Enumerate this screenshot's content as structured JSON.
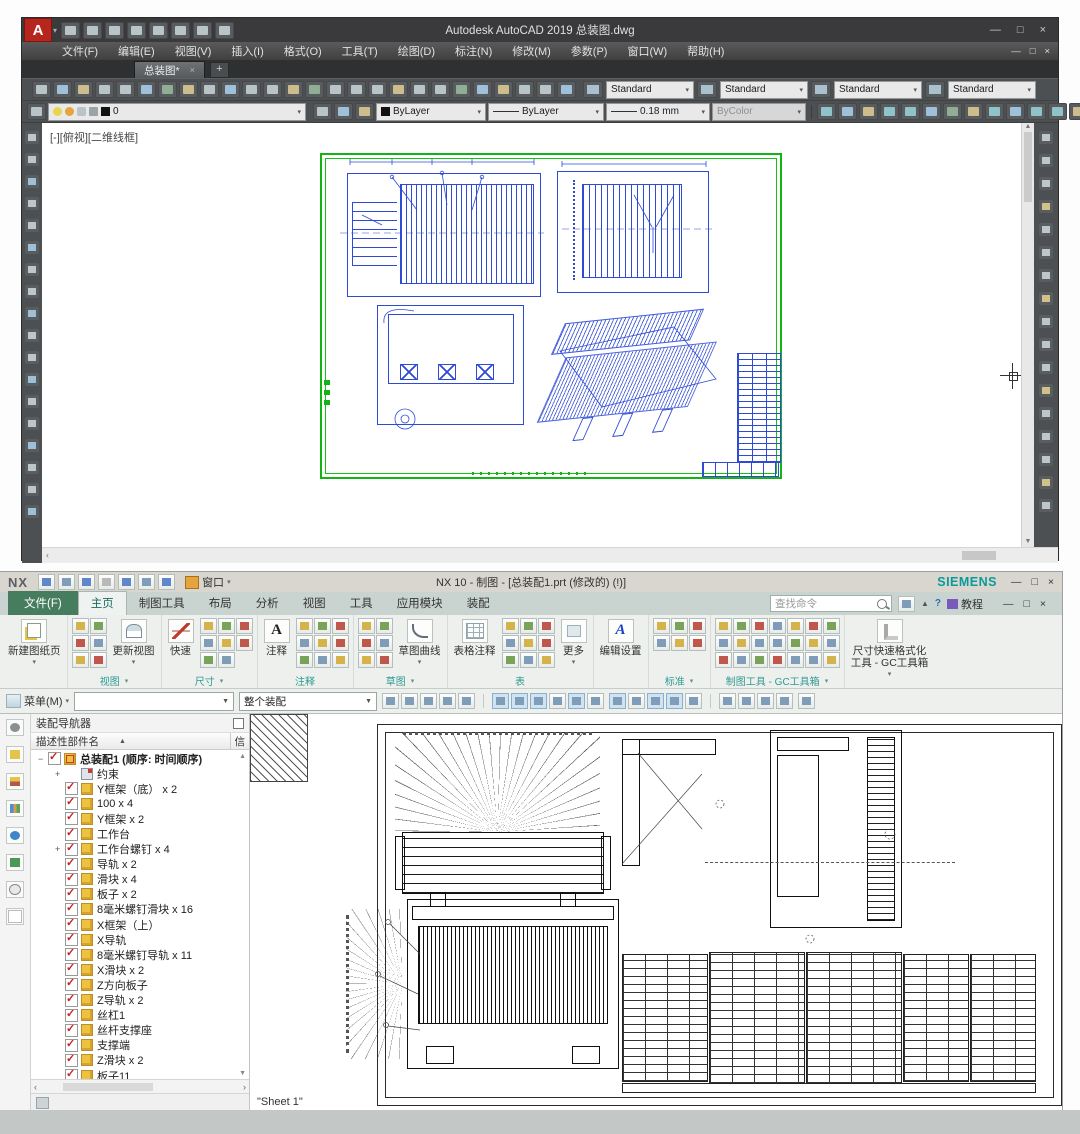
{
  "autocad": {
    "window_title": "Autodesk AutoCAD 2019   总装图.dwg",
    "menus": [
      "文件(F)",
      "编辑(E)",
      "视图(V)",
      "插入(I)",
      "格式(O)",
      "工具(T)",
      "绘图(D)",
      "标注(N)",
      "修改(M)",
      "参数(P)",
      "窗口(W)",
      "帮助(H)"
    ],
    "doc_tab": {
      "label": "总装图*",
      "close": "×",
      "new_tab": "+"
    },
    "qat_icons": [
      "new",
      "open",
      "save",
      "save-as",
      "plot",
      "undo",
      "redo",
      "customize"
    ],
    "toolbar1_icons": [
      "new",
      "open",
      "save",
      "print",
      "print-preview",
      "plot",
      "publish",
      "match-properties",
      "copy-clip",
      "paste-clip",
      "copy-base",
      "paste-block",
      "undo",
      "redo",
      "pan",
      "zoom-realtime",
      "zoom-window",
      "zoom-previous",
      "properties-palette",
      "design-center",
      "tool-palettes",
      "sheet-set-manager",
      "markup",
      "quick-calc",
      "help",
      "annotation-style"
    ],
    "style_combos": [
      {
        "icon": "text-style",
        "value": "Standard"
      },
      {
        "icon": "dim-style",
        "value": "Standard"
      },
      {
        "icon": "table-style",
        "value": "Standard"
      },
      {
        "icon": "mleader-style",
        "value": "Standard"
      }
    ],
    "layer_combo": {
      "value": "0"
    },
    "layer_icons": [
      "make-current",
      "match-layer",
      "previous-layer"
    ],
    "color_combo": "ByLayer",
    "linetype_combo": "ByLayer",
    "lineweight_combo": "0.18 mm",
    "plotstyle_combo": "ByColor",
    "dim_icons": [
      "linear-dim",
      "aligned-dim",
      "arc-length-dim",
      "ordinate-dim",
      "radius-dim",
      "jogged-dim",
      "diameter-dim",
      "angular-dim",
      "quick-dim",
      "baseline-dim",
      "continue-dim",
      "dim-space",
      "dim-break",
      "tolerance",
      "center-mark",
      "dim-update"
    ],
    "left_toolbar_icons": [
      "line",
      "construction-line",
      "polyline",
      "polygon",
      "rectangle",
      "arc",
      "circle",
      "revision-cloud",
      "spline",
      "ellipse",
      "insert-block",
      "make-block",
      "point",
      "hatch",
      "gradient",
      "region",
      "table",
      "multiline-text"
    ],
    "right_toolbar_icons": [
      "erase",
      "copy",
      "mirror",
      "offset",
      "array",
      "move",
      "rotate",
      "scale",
      "stretch",
      "trim",
      "extend",
      "break-at-point",
      "break",
      "join",
      "chamfer",
      "fillet",
      "explode"
    ],
    "viewport_label": "[-][俯视][二维线框]",
    "window_buttons": {
      "min": "—",
      "max": "□",
      "close": "×"
    },
    "mdi_buttons": {
      "min": "—",
      "restore": "□",
      "close": "×"
    }
  },
  "nx": {
    "logo": "NX",
    "window_title": "NX 10 - 制图 - [总装配1.prt (修改的)  (!)]",
    "brand": "SIEMENS",
    "qat_icons": [
      "save",
      "undo",
      "redo",
      "cut",
      "copy",
      "paste",
      "repaint"
    ],
    "window_menu": "窗口",
    "file_tab": "文件(F)",
    "tabs": [
      "主页",
      "制图工具",
      "布局",
      "分析",
      "视图",
      "工具",
      "应用模块",
      "装配"
    ],
    "search_placeholder": "查找命令",
    "help_label": "教程",
    "titlebar_buttons": {
      "min": "—",
      "restore": "□",
      "close": "×"
    },
    "ribbon": {
      "groups": [
        {
          "label": "",
          "big": "新建图纸页"
        },
        {
          "label": "视图",
          "big": "更新视图",
          "icons": [
            "view-wizard",
            "base-view",
            "projected-view",
            "detail-view",
            "section-view",
            "break-view"
          ]
        },
        {
          "label": "尺寸",
          "big": "快速",
          "icons": [
            "linear-dim",
            "radial-dim",
            "angular-dim",
            "chamfer-dim",
            "thickness-dim",
            "arc-length-dim",
            "ordinate-dim",
            "hole-callout"
          ]
        },
        {
          "label": "注释",
          "big": "注释",
          "icons": [
            "feature-control-frame",
            "datum-feature",
            "balloon",
            "surface-finish",
            "weld-symbol",
            "target-point",
            "intersection-symbol",
            "centerline",
            "crosshatch"
          ]
        },
        {
          "label": "草图",
          "big": "草图曲线",
          "icons": [
            "profile",
            "line",
            "arc",
            "circle",
            "fillet",
            "rectangle"
          ]
        },
        {
          "label": "表",
          "big": "表格注释",
          "big2": "更多",
          "icons": [
            "parts-list",
            "hole-table",
            "bend-table",
            "auto-balloon",
            "tabular-note",
            "update-parts-list",
            "sort-parts-list",
            "export-table",
            "edit-table"
          ]
        },
        {
          "label": "",
          "big": "编辑设置"
        },
        {
          "label": "标准",
          "icons": [
            "gb-standard",
            "projection-angle",
            "drawing-scale",
            "title-block",
            "frame-format",
            "revision-table"
          ]
        },
        {
          "label": "制图工具 - GC工具箱",
          "icons": [
            "gc-tool",
            "gc-tool",
            "gc-tool",
            "gc-tool",
            "gc-tool",
            "gc-tool",
            "gc-tool",
            "gc-tool",
            "gc-tool",
            "gc-tool",
            "gc-tool",
            "gc-tool",
            "gc-tool",
            "gc-tool",
            "gc-tool",
            "gc-tool",
            "gc-tool",
            "gc-tool",
            "gc-tool",
            "gc-tool",
            "gc-tool"
          ]
        },
        {
          "label": "",
          "big": "尺寸快速格式化工具 - GC工具箱"
        }
      ]
    },
    "toolbar": {
      "menu_label": "菜单(M)",
      "filter_value": "",
      "scope_value": "整个装配",
      "cluster1": [
        "selection-filter",
        "snap-point",
        "deselect",
        "reselect",
        "rect-select"
      ],
      "cluster2": [
        "snap-toggle",
        "endpoint-snap",
        "midpoint-snap",
        "spline-snap",
        "curve-snap",
        "cursor-snap"
      ],
      "cluster3": [
        "center-snap",
        "circle-snap",
        "plus-snap",
        "slash-snap",
        "gc-select"
      ],
      "cluster4": [
        "cascade-windows",
        "float-window",
        "tile-windows",
        "shortcut-toolbar"
      ],
      "cluster5": [
        "annotation-tool"
      ]
    },
    "navigator": {
      "panel_title": "装配导航器",
      "column_name": "描述性部件名",
      "sort_arrow": "▲",
      "column_info": "信",
      "root": {
        "label": "总装配1 (顺序: 时间顺序)",
        "minus": "−"
      },
      "items": [
        {
          "label": "约束",
          "plus": true,
          "icon": "cons",
          "chk": false
        },
        {
          "label": "Y框架（底） x 2",
          "icon": "cube",
          "chk": true
        },
        {
          "label": "100 x 4",
          "icon": "cube",
          "chk": true
        },
        {
          "label": "Y框架 x 2",
          "icon": "cube",
          "chk": true
        },
        {
          "label": "工作台",
          "icon": "cube",
          "chk": true
        },
        {
          "label": "工作台螺钉 x 4",
          "plus": true,
          "icon": "cube",
          "chk": true
        },
        {
          "label": "导轨 x 2",
          "icon": "cube",
          "chk": true
        },
        {
          "label": "滑块 x 4",
          "icon": "cube",
          "chk": true
        },
        {
          "label": "板子 x 2",
          "icon": "cube",
          "chk": true
        },
        {
          "label": "8毫米螺钉滑块 x 16",
          "icon": "cube",
          "chk": true
        },
        {
          "label": "X框架（上）",
          "icon": "cube",
          "chk": true
        },
        {
          "label": "X导轨",
          "icon": "cube",
          "chk": true
        },
        {
          "label": "8毫米螺钉导轨 x 11",
          "icon": "cube",
          "chk": true
        },
        {
          "label": "X滑块 x 2",
          "icon": "cube",
          "chk": true
        },
        {
          "label": "Z方向板子",
          "icon": "cube",
          "chk": true
        },
        {
          "label": "Z导轨 x 2",
          "icon": "cube",
          "chk": true
        },
        {
          "label": "丝杠1",
          "icon": "cube",
          "chk": true
        },
        {
          "label": "丝杆支撑座",
          "icon": "cube",
          "chk": true
        },
        {
          "label": "支撑端",
          "icon": "cube",
          "chk": true
        },
        {
          "label": "Z滑块 x 2",
          "icon": "cube",
          "chk": true
        },
        {
          "label": "板子11",
          "icon": "cube",
          "chk": true
        }
      ],
      "resource_icons": [
        "navigator-options",
        "assembly-navigator",
        "constraint-navigator",
        "part-navigator",
        "internet",
        "reuse-library",
        "history",
        "roles"
      ]
    },
    "graphics": {
      "sheet_label": "\"Sheet 1\""
    }
  },
  "colors": {
    "acad_frame_green": "#12b312",
    "acad_line_blue": "#2f4bd6",
    "acad_logo_red": "#b5271e",
    "nx_brand_teal": "#0b9a9a",
    "nx_file_tab_green": "#477d5f"
  }
}
